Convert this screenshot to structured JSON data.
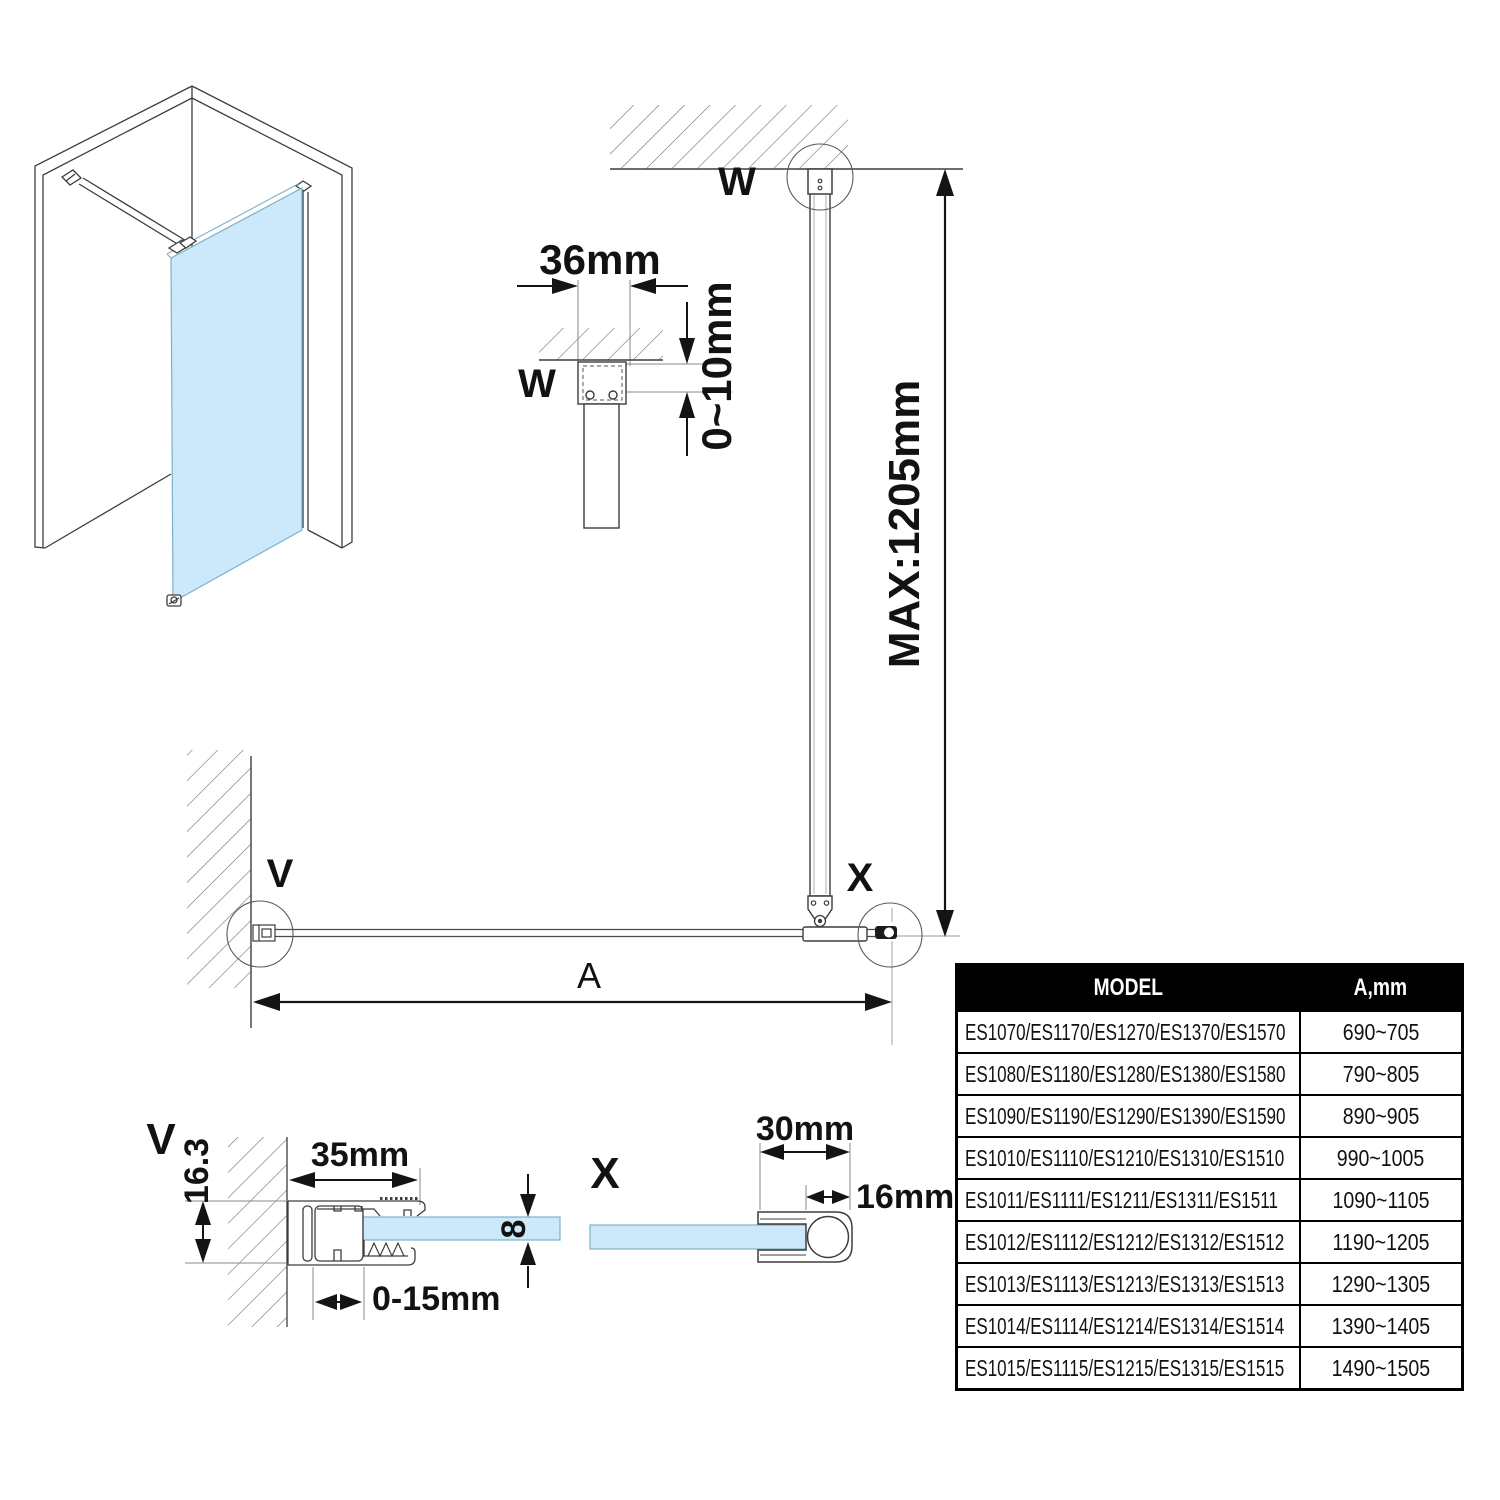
{
  "page": {
    "background": "#ffffff"
  },
  "colors": {
    "glass": "#cbe9fa",
    "glass_border": "#7fb0c8",
    "line": "#3d3d3d",
    "dimension": "#141414",
    "reference": "#8a8a8a",
    "hatch": "#6f6f6f",
    "table_header_bg": "#000000",
    "table_header_text": "#ffffff"
  },
  "detail_w_small": {
    "label": "W",
    "width_dim": "36mm",
    "ceiling_gap_dim": "0~10mm"
  },
  "elevation": {
    "top_label": "W",
    "wall_label": "V",
    "junction_label": "X",
    "max_height_dim": "MAX:1205mm",
    "width_dim_label": "A"
  },
  "detail_v": {
    "label": "V",
    "profile_depth_dim": "16.3",
    "profile_width_dim": "35mm",
    "adjust_range_dim": "0-15mm",
    "glass_thickness_dim": "8"
  },
  "detail_x": {
    "label": "X",
    "profile_width_dim": "30mm",
    "bar_dim": "16mm"
  },
  "table": {
    "headers": [
      "MODEL",
      "A,mm"
    ],
    "rows": [
      {
        "model": "ES1070/ES1170/ES1270/ES1370/ES1570",
        "a_mm": "690~705"
      },
      {
        "model": "ES1080/ES1180/ES1280/ES1380/ES1580",
        "a_mm": "790~805"
      },
      {
        "model": "ES1090/ES1190/ES1290/ES1390/ES1590",
        "a_mm": "890~905"
      },
      {
        "model": "ES1010/ES1110/ES1210/ES1310/ES1510",
        "a_mm": "990~1005"
      },
      {
        "model": "ES1011/ES1111/ES1211/ES1311/ES1511",
        "a_mm": "1090~1105"
      },
      {
        "model": "ES1012/ES1112/ES1212/ES1312/ES1512",
        "a_mm": "1190~1205"
      },
      {
        "model": "ES1013/ES1113/ES1213/ES1313/ES1513",
        "a_mm": "1290~1305"
      },
      {
        "model": "ES1014/ES1114/ES1214/ES1314/ES1514",
        "a_mm": "1390~1405"
      },
      {
        "model": "ES1015/ES1115/ES1215/ES1315/ES1515",
        "a_mm": "1490~1505"
      }
    ]
  }
}
